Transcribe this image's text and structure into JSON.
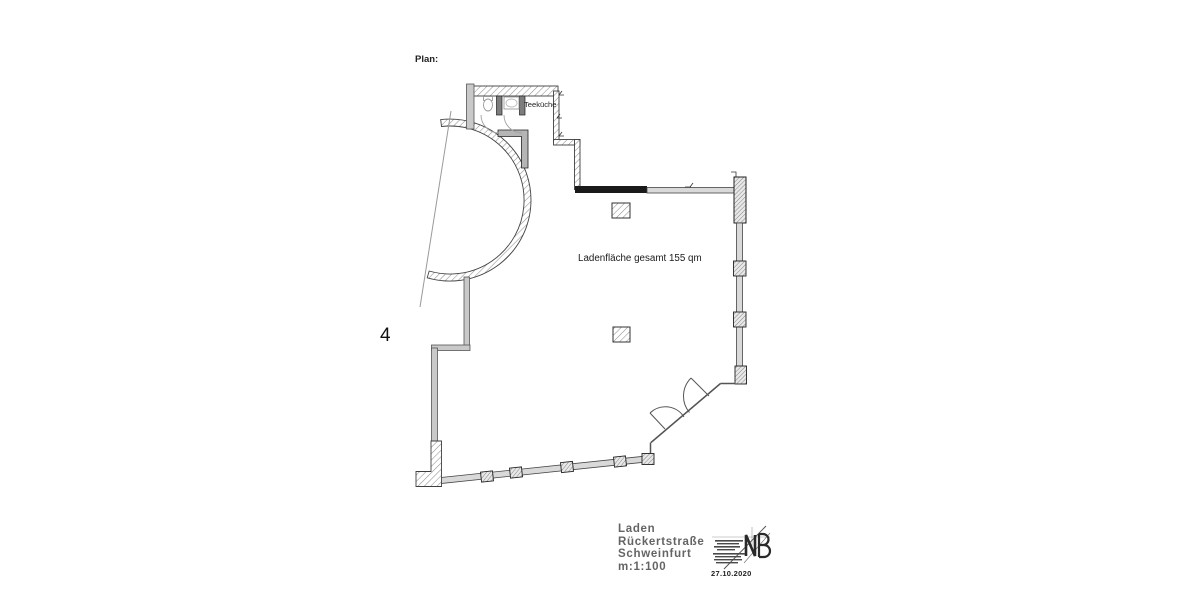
{
  "page": {
    "background": "#ffffff"
  },
  "plan": {
    "heading": "Plan:",
    "teekueche_label": "Teeküche",
    "area_note": "Ladenfläche gesamt 155 qm",
    "position_marker": "4"
  },
  "title_block": {
    "project": "Laden",
    "street": "Rückertstraße",
    "city": "Schweinfurt",
    "scale": "m:1:100"
  },
  "stamp": {
    "date": "27.10.2020"
  },
  "colors": {
    "wall_fill": "#c9c9c9",
    "window_wall_fill": "#d9d9d9",
    "wall_outline": "#3f3f3f",
    "hatch_line": "#8f8f8f",
    "dark_wall": "#1a1a1a",
    "thin_line": "#9a9a9a",
    "text": "#222222",
    "title_text": "#4a4a4a"
  }
}
